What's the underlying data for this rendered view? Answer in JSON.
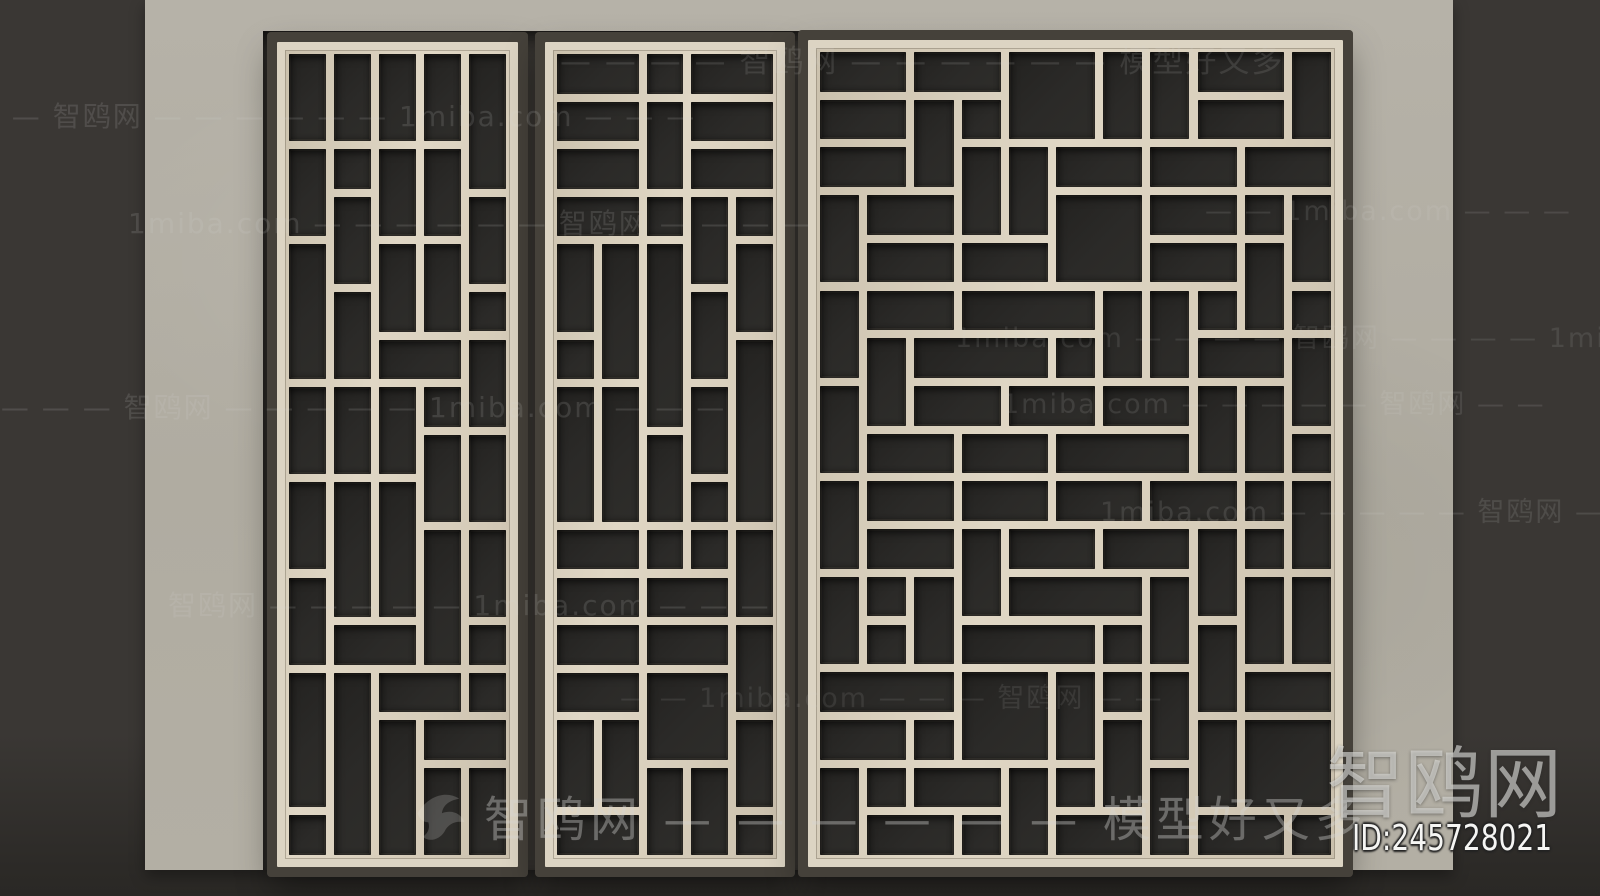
{
  "colors": {
    "wall": "#b2aea3",
    "background": "#3a3734",
    "opening": "#3a3733",
    "frame_reveal": "#45413a",
    "lattice_bar": "#d9d0bf",
    "lattice_cell": "#2a2927",
    "watermark": "#d6d6d4",
    "id_text": "#f5f5f3"
  },
  "panels": [
    {
      "x": 277,
      "y": 42,
      "w": 241,
      "h": 825,
      "cols": 5,
      "rows": 17,
      "seed": 11,
      "shapes": [
        [
          1,
          1,
          14
        ],
        [
          2,
          1,
          20
        ],
        [
          1,
          2,
          26
        ],
        [
          1,
          3,
          12
        ],
        [
          3,
          1,
          8
        ],
        [
          2,
          2,
          7
        ],
        [
          1,
          4,
          5
        ]
      ]
    },
    {
      "x": 545,
      "y": 42,
      "w": 240,
      "h": 825,
      "cols": 5,
      "rows": 17,
      "seed": 29,
      "shapes": [
        [
          1,
          1,
          14
        ],
        [
          2,
          1,
          20
        ],
        [
          1,
          2,
          26
        ],
        [
          1,
          3,
          12
        ],
        [
          3,
          1,
          8
        ],
        [
          2,
          2,
          7
        ],
        [
          1,
          4,
          5
        ]
      ]
    },
    {
      "x": 808,
      "y": 40,
      "w": 535,
      "h": 827,
      "cols": 11,
      "rows": 17,
      "seed": 7,
      "shapes": [
        [
          2,
          1,
          42
        ],
        [
          1,
          2,
          24
        ],
        [
          1,
          1,
          12
        ],
        [
          3,
          1,
          5
        ],
        [
          2,
          2,
          3
        ]
      ]
    }
  ],
  "watermarks": {
    "tiles": [
      {
        "text": "— — — — 智鸥网 — — — — — — 模型好又多",
        "x": 560,
        "y": 36,
        "size": 31,
        "opacity": 0.13
      },
      {
        "text": "— — — 智鸥网 — — — — — — 1miba.com — — —",
        "x": -70,
        "y": 95,
        "size": 28,
        "opacity": 0.14
      },
      {
        "text": "1miba.com — — — — — — 智鸥网 — — — —",
        "x": 128,
        "y": 202,
        "size": 28,
        "opacity": 0.14
      },
      {
        "text": "— — 1miba.com — — —",
        "x": 1205,
        "y": 196,
        "size": 27,
        "opacity": 0.12
      },
      {
        "text": "1miba.com — — — — 智鸥网 — — — — 1miba.com",
        "x": 955,
        "y": 316,
        "size": 27,
        "opacity": 0.11
      },
      {
        "text": "— — — — 智鸥网 — — — — — 1miba.com — — —",
        "x": -40,
        "y": 386,
        "size": 28,
        "opacity": 0.14
      },
      {
        "text": "1miba.com — — — — — 智鸥网 — —",
        "x": 1002,
        "y": 382,
        "size": 27,
        "opacity": 0.12
      },
      {
        "text": "1miba.com — — — — — 智鸥网 — — — —",
        "x": 1100,
        "y": 490,
        "size": 27,
        "opacity": 0.13
      },
      {
        "text": "智鸥网 — — — — — 1miba.com — — —",
        "x": 168,
        "y": 584,
        "size": 28,
        "opacity": 0.14
      },
      {
        "text": "— — 1miba.com — — — 智鸥网 — —",
        "x": 620,
        "y": 676,
        "size": 27,
        "opacity": 0.1
      }
    ],
    "center": {
      "text": "智鸥网 — — — — — — 模型好又多",
      "x": 412,
      "y": 780,
      "size": 48,
      "opacity": 0.38
    },
    "brand": {
      "text": "智鸥网",
      "x": 1326,
      "y": 722,
      "size": 78
    },
    "id": {
      "text": "ID:245728021",
      "x": 1352,
      "y": 818,
      "size": 36
    }
  }
}
